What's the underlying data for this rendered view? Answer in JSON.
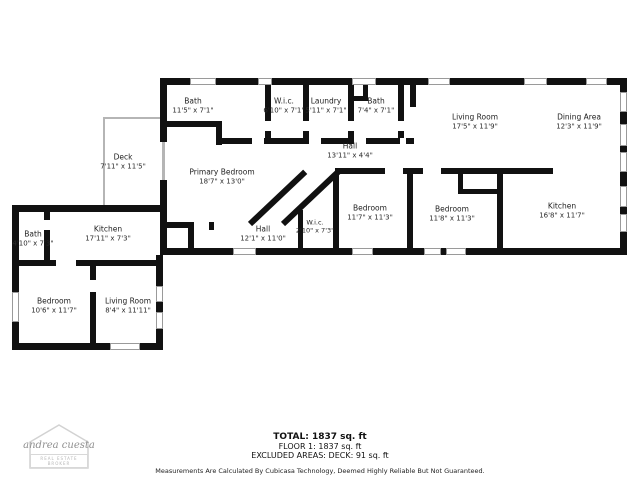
{
  "colors": {
    "wall": "#111111",
    "window_frame": "#9a9a9a",
    "deck_line": "#b5b5b5",
    "label_text": "#1e1e1e"
  },
  "rooms": [
    {
      "id": "bath-top",
      "name": "Bath",
      "dims": "11'5\" x 7'1\""
    },
    {
      "id": "wic-top",
      "name": "W.i.c.",
      "dims": "6'10\" x 7'1\""
    },
    {
      "id": "laundry",
      "name": "Laundry",
      "dims": "5'11\" x 7'1\""
    },
    {
      "id": "bath-2",
      "name": "Bath",
      "dims": "7'4\" x 7'1\""
    },
    {
      "id": "hall-upper",
      "name": "Hall",
      "dims": "13'11\" x 4'4\""
    },
    {
      "id": "living-room-main",
      "name": "Living Room",
      "dims": "17'5\" x 11'9\""
    },
    {
      "id": "dining-area",
      "name": "Dining Area",
      "dims": "12'3\" x 11'9\""
    },
    {
      "id": "primary-bedroom",
      "name": "Primary Bedroom",
      "dims": "18'7\" x 13'0\""
    },
    {
      "id": "deck",
      "name": "Deck",
      "dims": "7'11\" x 11'5\""
    },
    {
      "id": "hall-lower",
      "name": "Hall",
      "dims": "12'1\" x 11'0\""
    },
    {
      "id": "wic-2",
      "name": "W.i.c.",
      "dims": "2'10\" x 7'3\""
    },
    {
      "id": "bedroom-1",
      "name": "Bedroom",
      "dims": "11'7\" x 11'3\""
    },
    {
      "id": "bedroom-2",
      "name": "Bedroom",
      "dims": "11'8\" x 11'3\""
    },
    {
      "id": "kitchen-main",
      "name": "Kitchen",
      "dims": "16'8\" x 11'7\""
    },
    {
      "id": "bath-annex",
      "name": "Bath",
      "dims": "4'10\" x 7'3\""
    },
    {
      "id": "kitchen-annex",
      "name": "Kitchen",
      "dims": "17'11\" x 7'3\""
    },
    {
      "id": "bedroom-annex",
      "name": "Bedroom",
      "dims": "10'6\" x 11'7\""
    },
    {
      "id": "living-room-annex",
      "name": "Living Room",
      "dims": "8'4\" x 11'11\""
    }
  ],
  "footer": {
    "total": "TOTAL: 1837 sq. ft",
    "floor": "FLOOR 1: 1837 sq. ft",
    "excluded": "EXCLUDED AREAS: DECK: 91 sq. ft",
    "disclaimer": "Measurements Are Calculated By Cubicasa Technology, Deemed Highly Reliable But Not Guaranteed."
  },
  "logo": {
    "name": "andrea cuesta",
    "tagline": "REAL ESTATE BROKER"
  }
}
